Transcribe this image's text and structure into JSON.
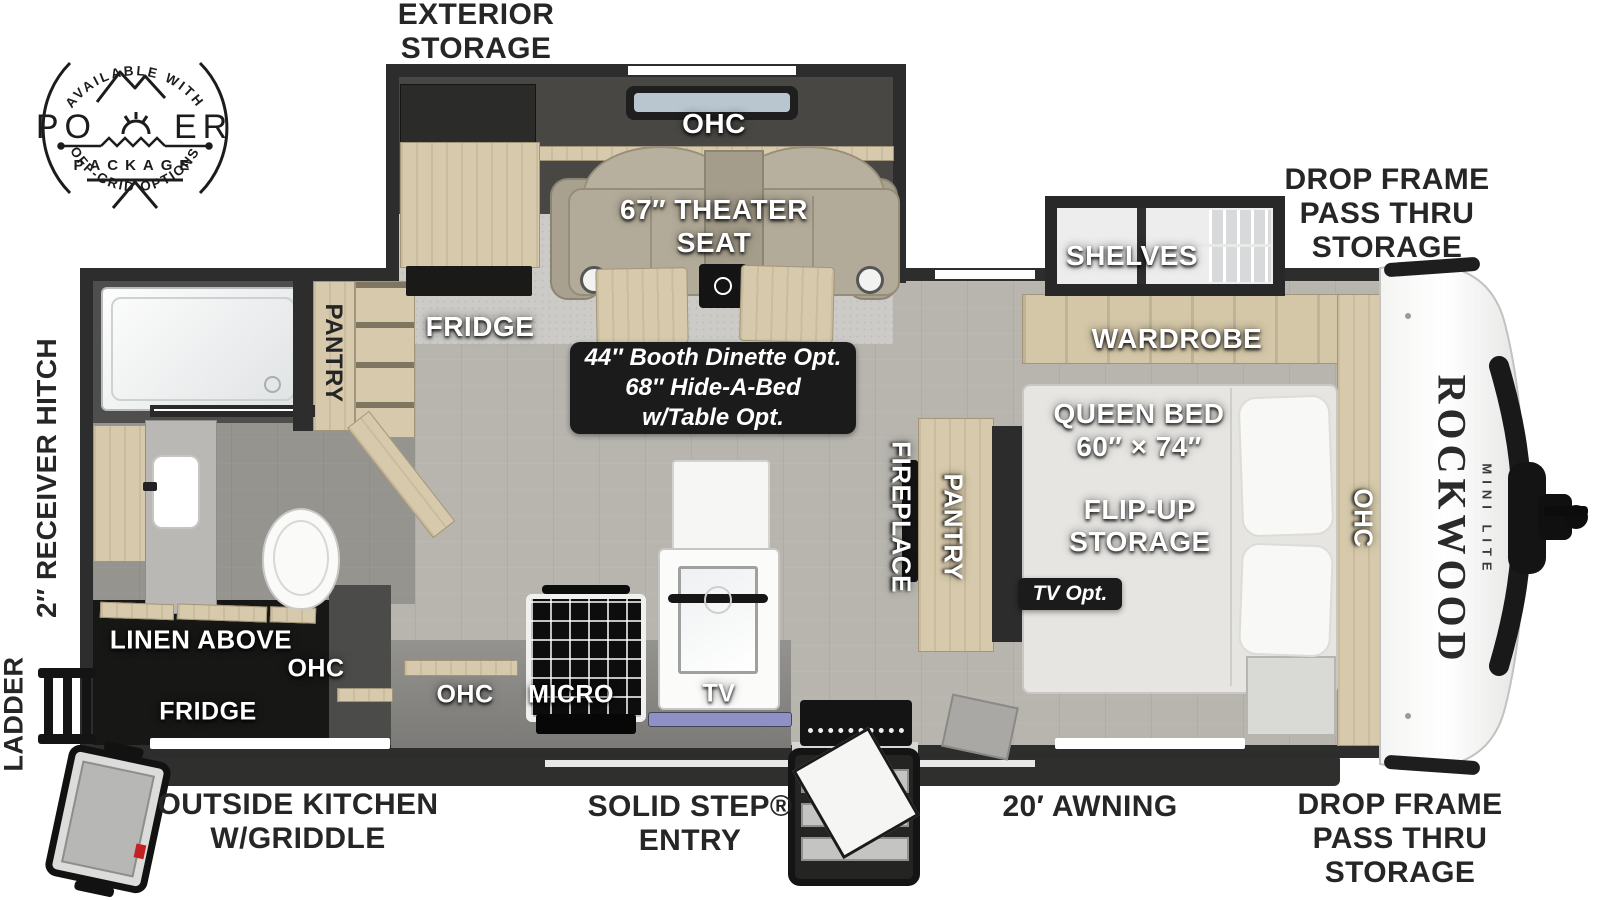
{
  "brand": {
    "name": "ROCKWOOD",
    "model": "MINI LITE"
  },
  "logo": {
    "arc_top": "AVAILABLE WITH",
    "word_p1": "PO",
    "word_p2": "ER",
    "sub": "PACKAGE",
    "arc_bottom": "OFF-GRID OPTIONS"
  },
  "exterior_labels": {
    "exterior_storage": [
      "EXTERIOR",
      "STORAGE"
    ],
    "drop_frame_top": [
      "DROP FRAME",
      "PASS THRU",
      "STORAGE"
    ],
    "drop_frame_bottom": [
      "DROP FRAME",
      "PASS THRU",
      "STORAGE"
    ],
    "outside_kitchen": [
      "OUTSIDE KITCHEN",
      "W/GRIDDLE"
    ],
    "solid_step": [
      "SOLID STEP®",
      "ENTRY"
    ],
    "awning": "20′ AWNING",
    "receiver_hitch": "2″ RECEIVER HITCH",
    "ladder": "LADDER"
  },
  "room_labels": {
    "ohc_slide": "OHC",
    "theater_line1": "67″ THEATER",
    "theater_line2": "SEAT",
    "fridge_slide": "FRIDGE",
    "shelves": "SHELVES",
    "wardrobe": "WARDROBE",
    "queen_bed_line1": "QUEEN BED",
    "queen_bed_line2": "60″ × 74″",
    "flip_up_line1": "FLIP-UP",
    "flip_up_line2": "STORAGE",
    "fireplace": "FIREPLACE",
    "pantry_main": "PANTRY",
    "pantry_bath": "PANTRY",
    "linen_above": "LINEN ABOVE",
    "ohc_bath": "OHC",
    "fridge_bath": "FRIDGE",
    "ohc_kitchen": "OHC",
    "micro": "MICRO",
    "tv": "TV",
    "ohc_bed": "OHC"
  },
  "badges": {
    "dinette": [
      "44″ Booth Dinette Opt.",
      "68″ Hide-A-Bed",
      "w/Table Opt."
    ],
    "tv_opt": "TV Opt."
  },
  "colors": {
    "wall": "#2d2d2d",
    "floor": "#b7b5ae",
    "cabinet_tan": "#d7caac",
    "badge_black": "#1b1b1b",
    "label_white": "#ffffff",
    "tv_strip": "#8f90c3"
  }
}
